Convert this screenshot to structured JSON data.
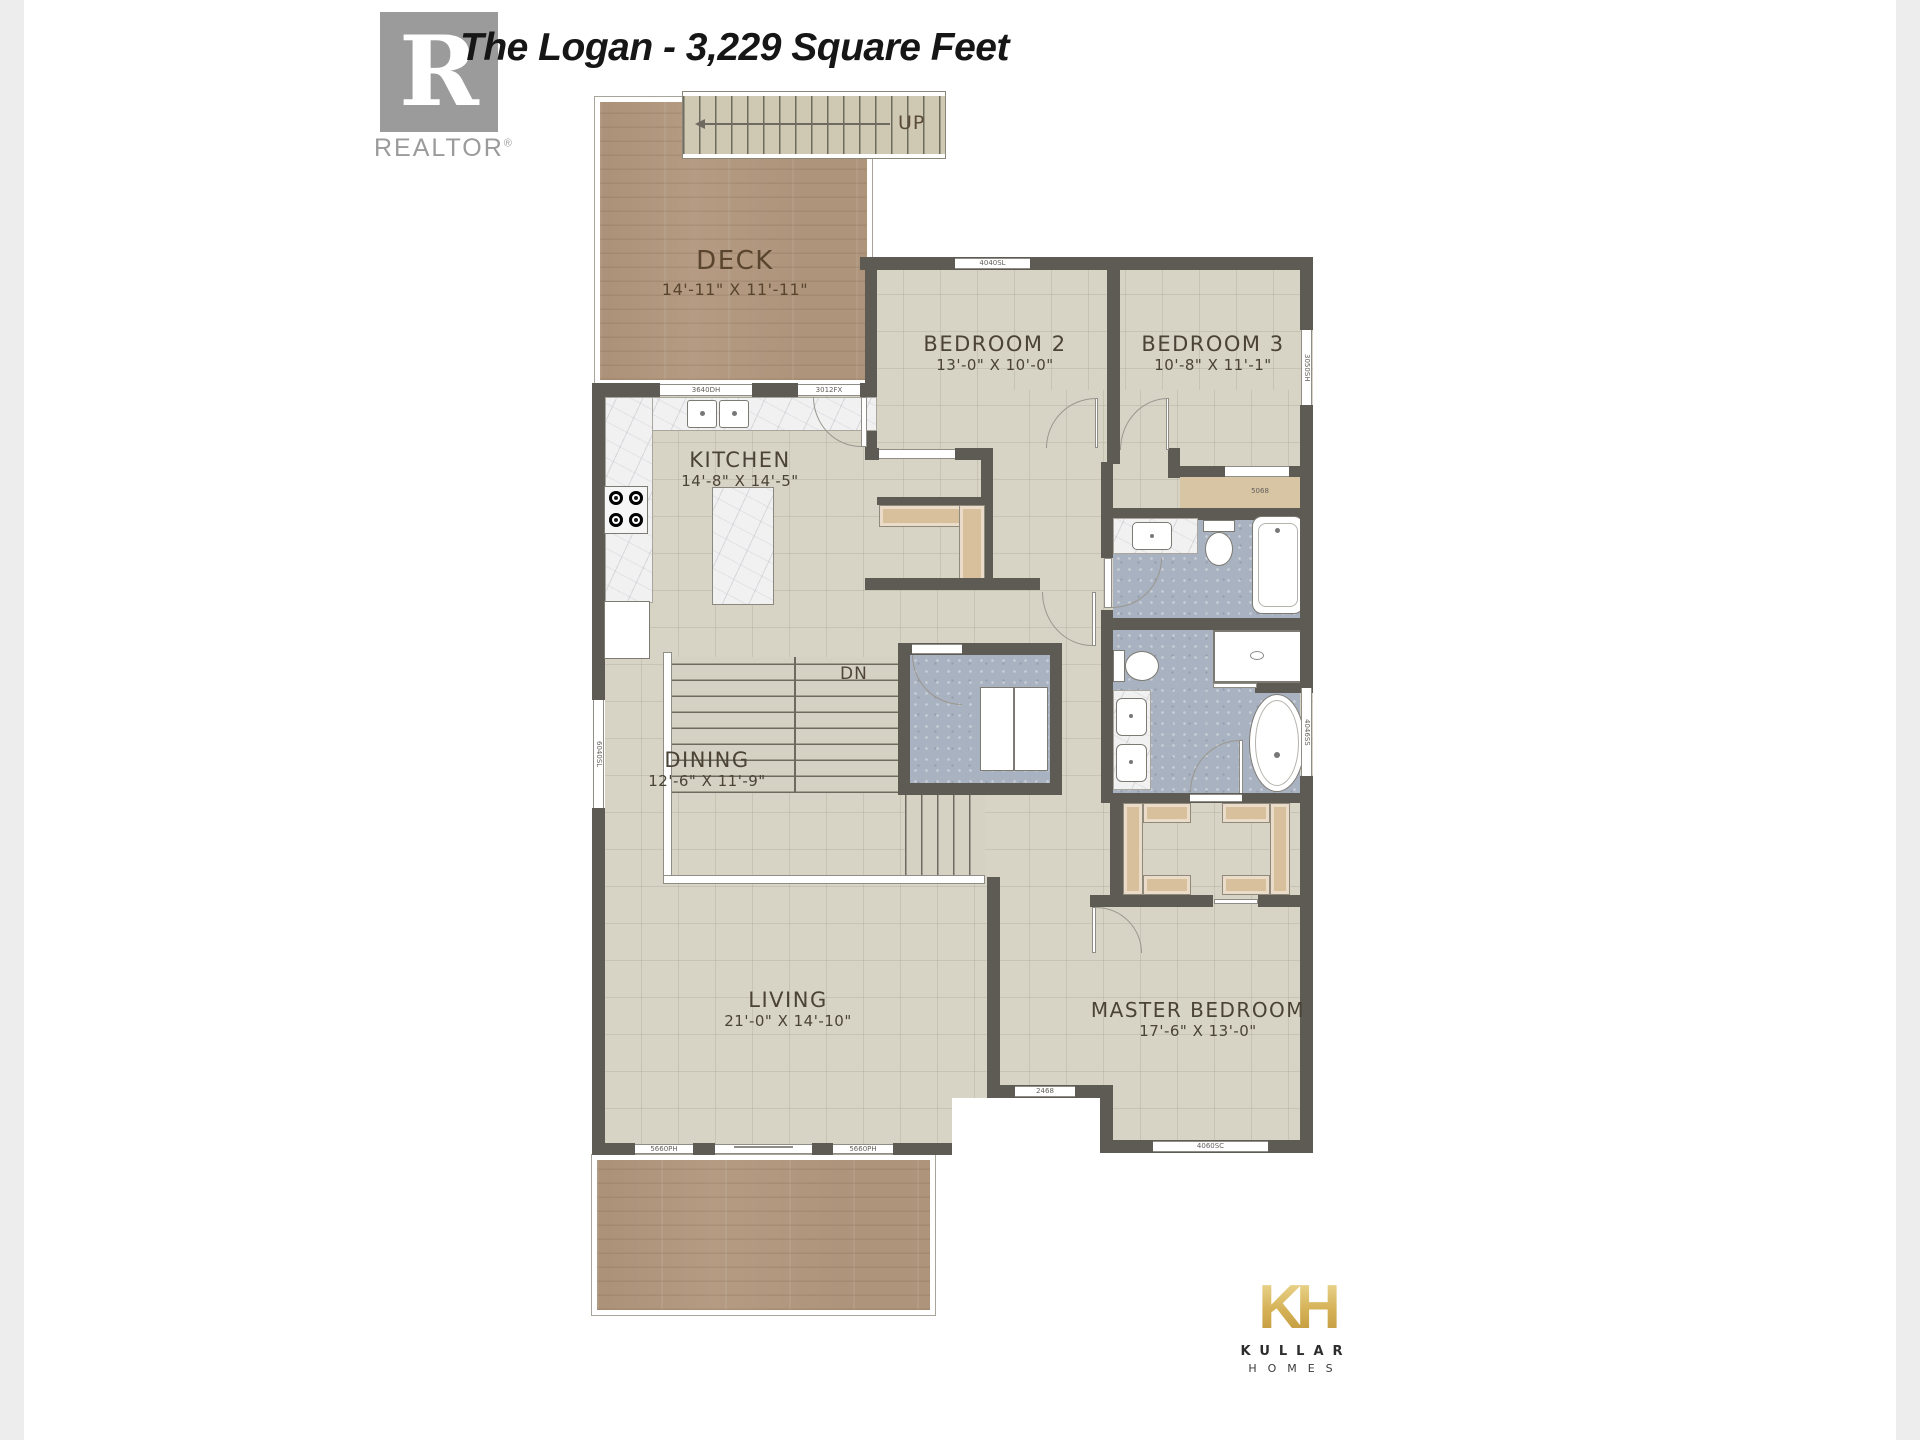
{
  "page": {
    "bg": "#ffffff",
    "side_bar_color": "#ededed"
  },
  "header": {
    "title": "The Logan - 3,229 Square Feet",
    "realtor": {
      "letter": "R",
      "wordmark": "REALTOR",
      "reg": "®"
    }
  },
  "stairs": {
    "up_label": "UP",
    "down_label": "DN"
  },
  "rooms": {
    "deck": {
      "name": "DECK",
      "dims": "14'-11\" X 11'-11\""
    },
    "kitchen": {
      "name": "KITCHEN",
      "dims": "14'-8\" X 14'-5\""
    },
    "dining": {
      "name": "DINING",
      "dims": "12'-6\" X 11'-9\""
    },
    "living": {
      "name": "LIVING",
      "dims": "21'-0\" X 14'-10\""
    },
    "bedroom2": {
      "name": "BEDROOM 2",
      "dims": "13'-0\" X 10'-0\""
    },
    "bedroom3": {
      "name": "BEDROOM 3",
      "dims": "10'-8\" X 11'-1\""
    },
    "master": {
      "name": "MASTER BEDROOM",
      "dims": "17'-6\" X 13'-0\""
    }
  },
  "windows": {
    "kitchen_left": "3640DH",
    "kitchen_right": "3012FX",
    "bedroom2_top": "4040SL",
    "bedroom3_right": "3050SH",
    "bath_right": "4046SS",
    "dining_left": "6040SL",
    "living_left": "5660PH",
    "living_right": "5660PH",
    "master_bottom": "4060SC",
    "corridor": "2468",
    "closet_door": "5068"
  },
  "footer_logo": {
    "monogram": "KH",
    "line1": "KULLAR",
    "line2": "HOMES",
    "gold": "#d4af5a"
  },
  "colors": {
    "wall": "#5e5b55",
    "floor": "#d7d3c5",
    "wood_deck": "#b49b82",
    "bath_floor": "#a9b2c0",
    "closet_shelf": "#d9c09c",
    "stair_tread": "#cfc9b4",
    "realtor_grey": "#9b9b9b",
    "title_text": "#161616"
  }
}
